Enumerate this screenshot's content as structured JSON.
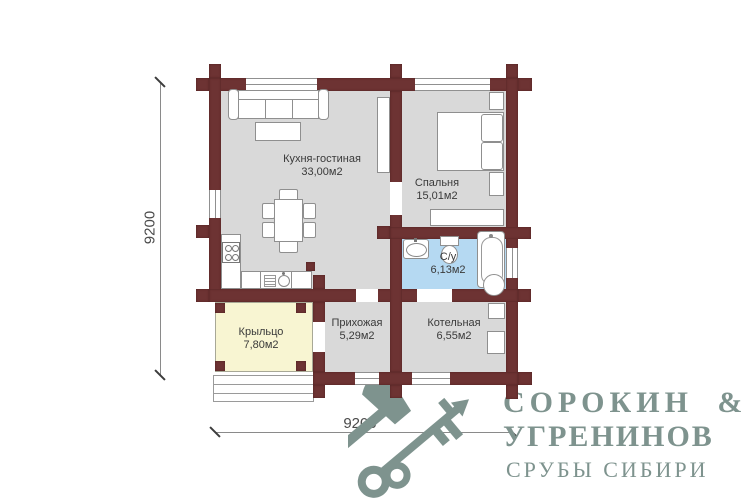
{
  "plan": {
    "rooms": [
      {
        "label": "Кухня-гостиная",
        "area": "33,00м2"
      },
      {
        "label": "Спальня",
        "area": "15,01м2"
      },
      {
        "label": "С/у",
        "area": "6,13м2"
      },
      {
        "label": "Крыльцо",
        "area": "7,80м2"
      },
      {
        "label": "Прихожая",
        "area": "5,29м2"
      },
      {
        "label": "Котельная",
        "area": "6,55м2"
      }
    ],
    "dimensions": {
      "left": "9200",
      "bottom": "9200"
    }
  },
  "logo": {
    "line1": "СОРОКИН &",
    "line2": "УГРЕНИНОВ",
    "line3": "СРУБЫ СИБИРИ"
  },
  "colors": {
    "wall": "#6d3333",
    "floor": "#d9d9d9",
    "bathroom_floor": "#b5d9f2",
    "porch_floor": "#f8f5d2",
    "logo": "#7e938e"
  }
}
